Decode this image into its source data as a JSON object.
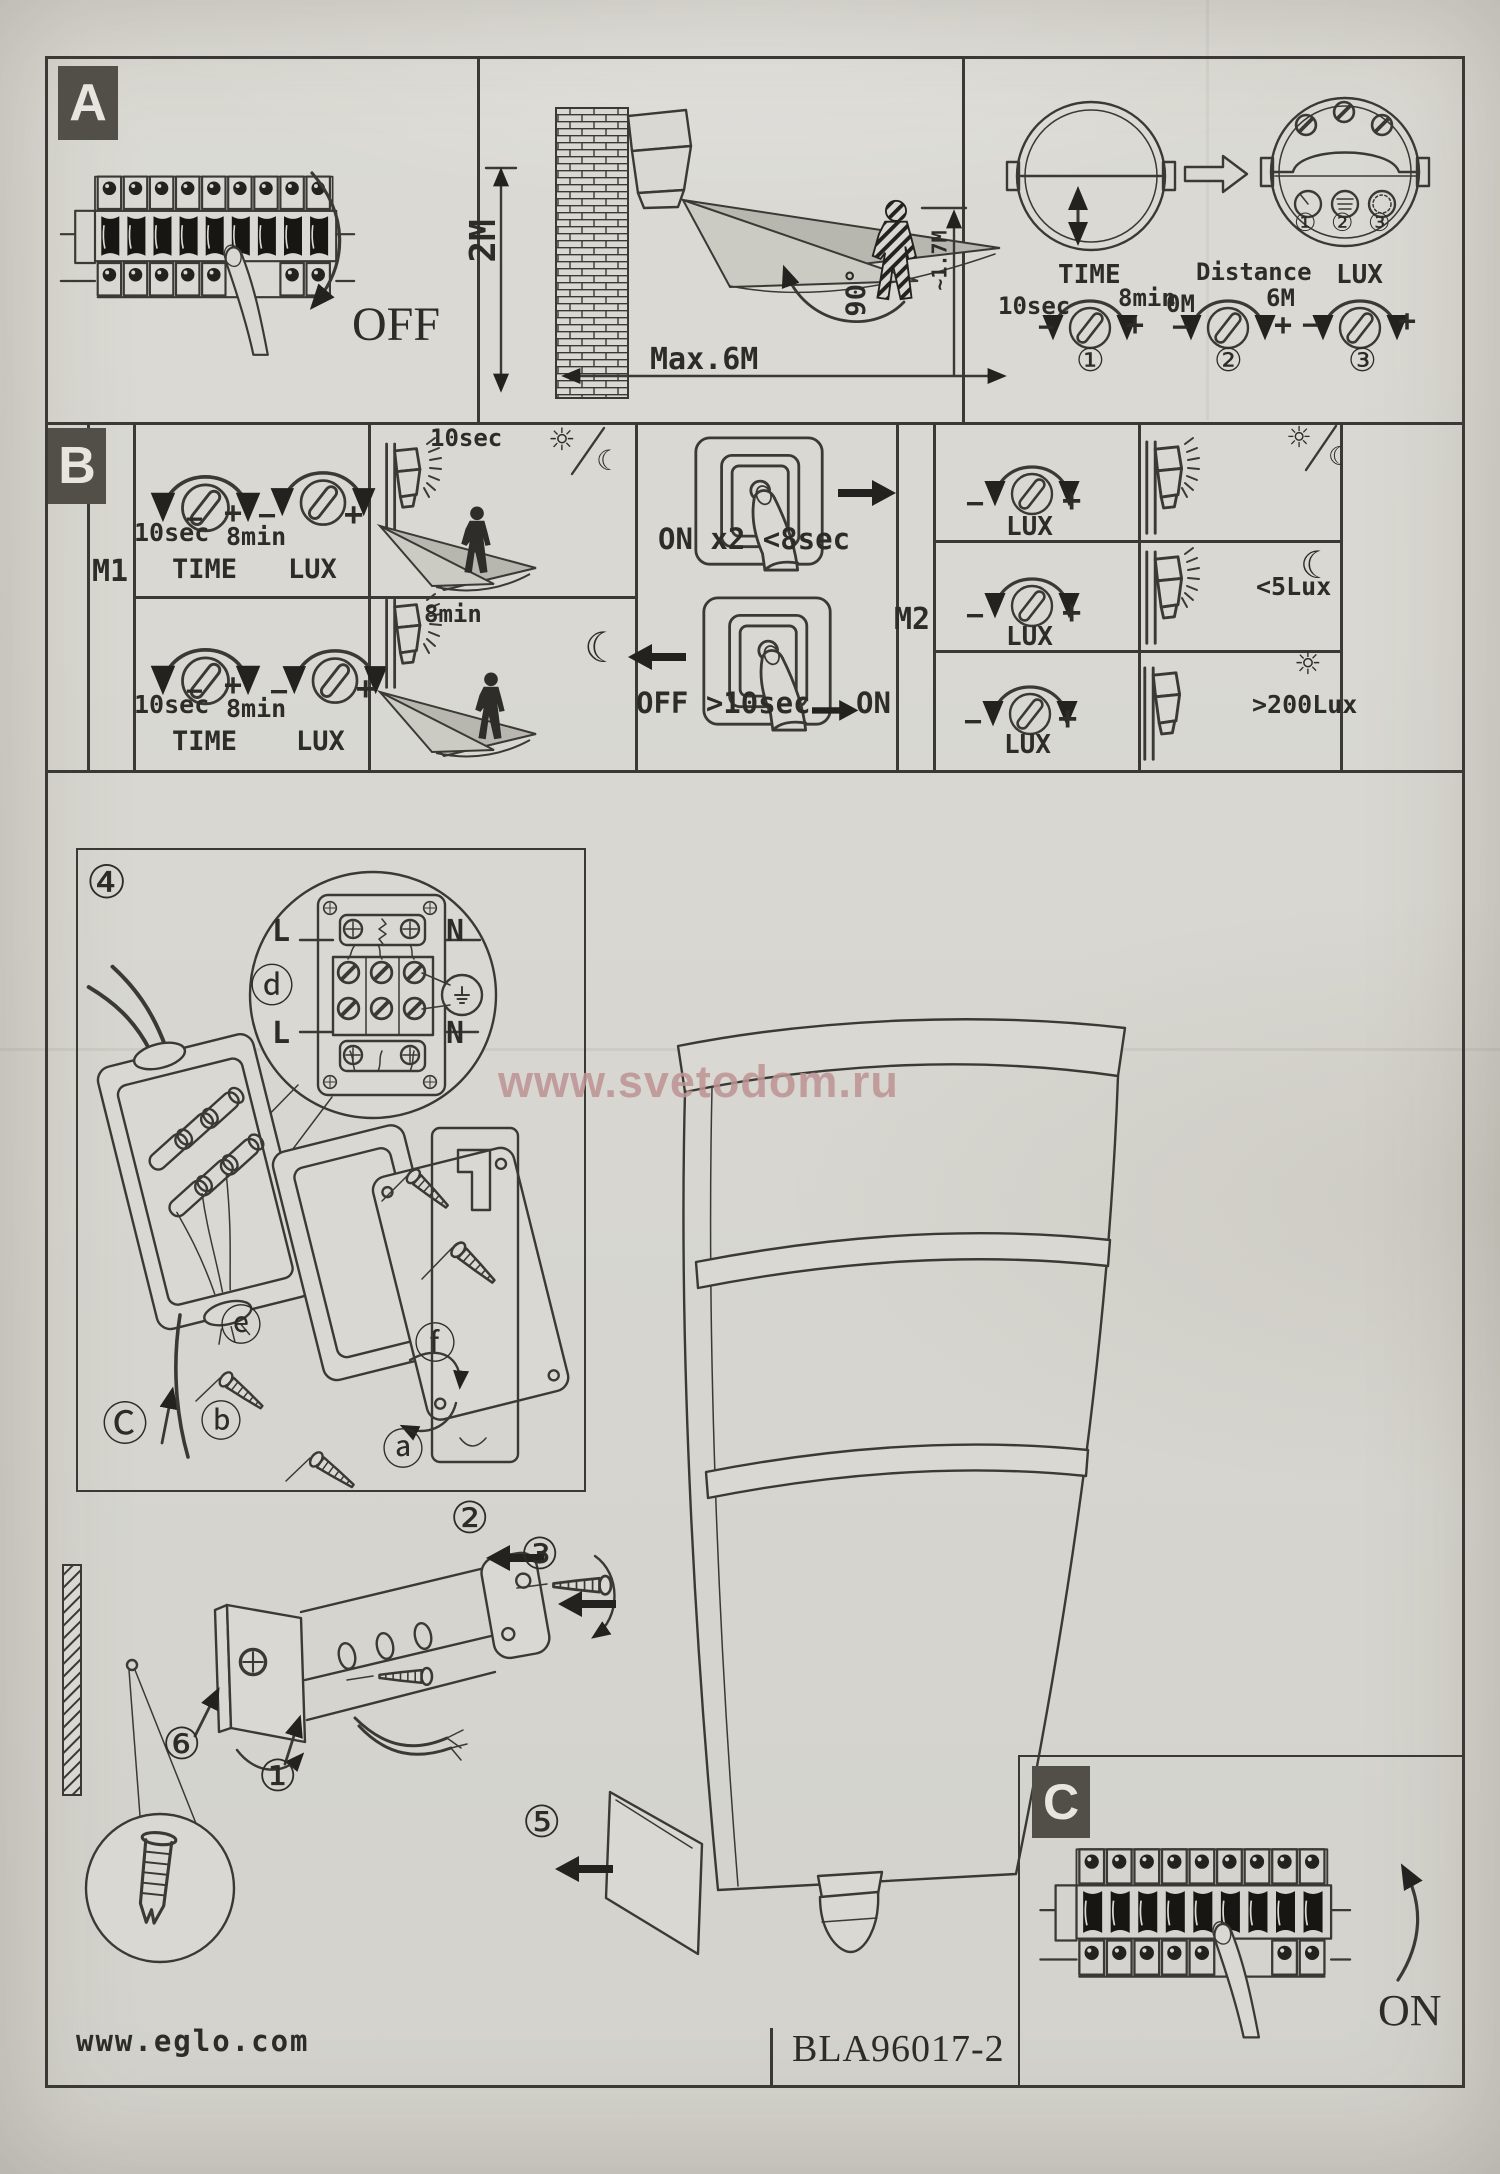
{
  "sections": {
    "a": "A",
    "b": "B",
    "c": "C",
    "wiring_step": "④"
  },
  "a": {
    "off": "OFF",
    "wall_height": "2M",
    "max_range": "Max.6M",
    "sweep_angle": "90°",
    "person_height": "~1.7M",
    "time": {
      "name": "TIME",
      "min": "10sec",
      "max": "8min",
      "num": "①"
    },
    "distance": {
      "name": "Distance",
      "min": "0M",
      "max": "6M",
      "num": "②"
    },
    "lux": {
      "name": "LUX",
      "num": "③"
    }
  },
  "sym": {
    "minus": "−",
    "plus": "+",
    "sun": "☼",
    "moon": "☾"
  },
  "b": {
    "m1": "M1",
    "m2": "M2",
    "m1_rows": [
      {
        "time_min": "10sec",
        "time_max": "8min",
        "time_label": "TIME",
        "lux_label": "LUX",
        "caption": "10sec"
      },
      {
        "time_min": "10sec",
        "time_max": "8min",
        "time_label": "TIME",
        "lux_label": "LUX",
        "caption": "8min"
      }
    ],
    "on_gesture": "ON x2 <8sec",
    "off_gesture": "OFF >10sec",
    "off_result": "ON",
    "m2_rows": [
      {
        "lux_label": "LUX",
        "caption": ""
      },
      {
        "lux_label": "LUX",
        "caption": "<5Lux"
      },
      {
        "lux_label": "LUX",
        "caption": ">200Lux"
      }
    ]
  },
  "wiring": {
    "l_top": "L",
    "n_top": "N",
    "l_bot": "L",
    "n_bot": "N",
    "d": "ⓓ",
    "e": "ⓔ",
    "f": "ⓕ",
    "c": "Ⓒ",
    "b": "ⓑ",
    "a": "ⓐ"
  },
  "assembly": {
    "n1": "①",
    "n2": "②",
    "n3": "③",
    "n5": "⑤",
    "n6": "⑥"
  },
  "c": {
    "on": "ON"
  },
  "watermark": "www.svetodom.ru",
  "footer": {
    "site": "www.eglo.com",
    "model": "BLA96017-2"
  }
}
